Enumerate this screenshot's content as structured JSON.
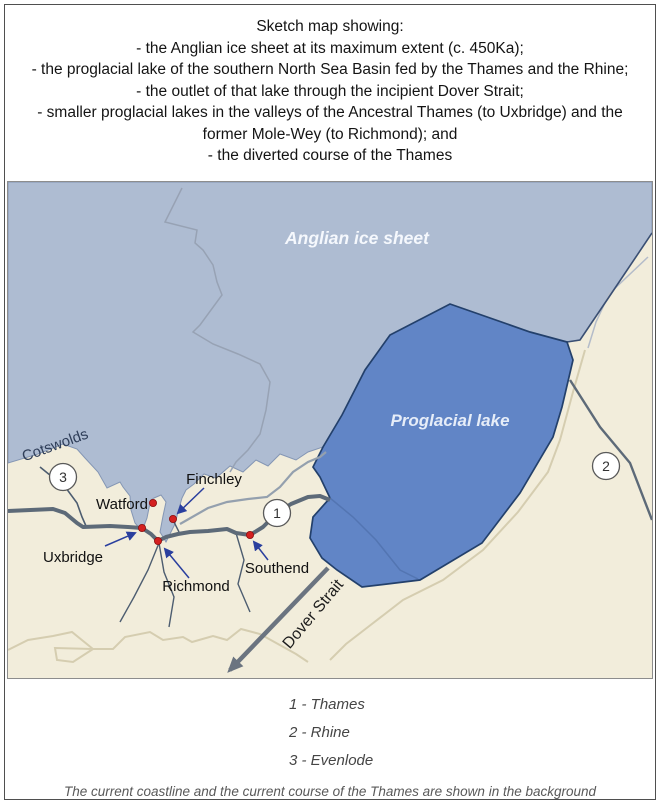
{
  "title": {
    "heading": "Sketch map showing:",
    "bullets": [
      "- the Anglian ice sheet at its maximum extent (c. 450Ka);",
      "- the proglacial lake of the southern North Sea Basin fed by the Thames and the Rhine;",
      "- the outlet of that lake through the incipient Dover Strait;",
      "- smaller proglacial lakes in the valleys of the Ancestral Thames (to Uxbridge) and the former Mole-Wey (to Richmond); and",
      "- the diverted course of the Thames"
    ]
  },
  "map": {
    "region_labels": {
      "ice_sheet": "Anglian ice sheet",
      "proglacial_lake": "Proglacial lake",
      "cotswolds": "Cotswolds",
      "dover_strait": "Dover Strait"
    },
    "place_labels": {
      "watford": "Watford",
      "finchley": "Finchley",
      "uxbridge": "Uxbridge",
      "richmond": "Richmond",
      "southend": "Southend"
    },
    "route_numbers": {
      "thames": "1",
      "rhine": "2",
      "evenlode": "3"
    },
    "colors": {
      "land": "#f2eddb",
      "ice": "#aebcd2",
      "lake": "#6185c6",
      "lake_outline": "#23406b",
      "river_main": "#5d6a78",
      "river_thin": "#4d5d70",
      "river_background": "#94a0ae",
      "coastline_background": "#d5cdb0",
      "marker_dot": "#d42020",
      "pointer_arrow": "#2a3f9e"
    }
  },
  "legend": {
    "items": [
      "1 - Thames",
      "2 - Rhine",
      "3 - Evenlode"
    ],
    "note": "The current coastline and the current course of the Thames are shown in the background"
  }
}
